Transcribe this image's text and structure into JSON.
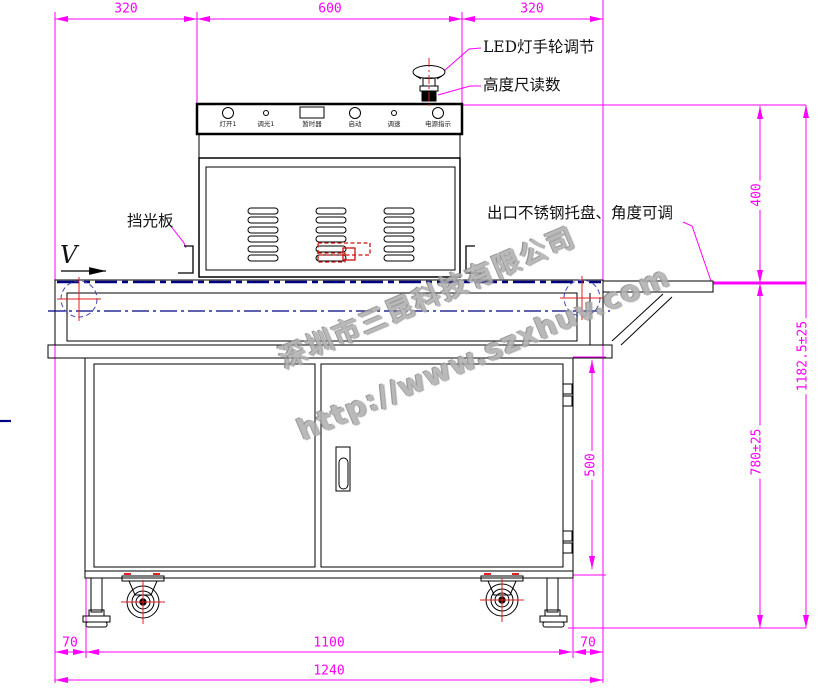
{
  "dims": {
    "top_left": "320",
    "top_mid": "600",
    "top_right": "320",
    "right_400": "400",
    "right_1182": "1182.5±25",
    "right_780": "780±25",
    "right_500": "500",
    "bottom_left70": "70",
    "bottom_1100": "1100",
    "bottom_right70": "70",
    "bottom_1240": "1240"
  },
  "annotations": {
    "led_handwheel": "LED灯手轮调节",
    "height_gauge": "高度尺读数",
    "light_shield": "挡光板",
    "outlet_tray": "出口不锈钢托盘、角度可调",
    "belt_direction": "V"
  },
  "control_panel": {
    "items": [
      {
        "label": "灯开1",
        "type": "circle-large"
      },
      {
        "label": "调光1",
        "type": "circle-small"
      },
      {
        "label": "暂时器",
        "type": "rect-window"
      },
      {
        "label": "启动",
        "type": "circle-large"
      },
      {
        "label": "调速",
        "type": "circle-small"
      },
      {
        "label": "电源指示",
        "type": "circle-large"
      }
    ]
  },
  "watermark": {
    "company": "深圳市三昆科技有限公司",
    "url": "http://www.szxhuv.com"
  },
  "colors": {
    "dimension": "#FF00FF",
    "line": "#000000",
    "belt": "#000080",
    "centerline": "#E02020",
    "roller_circle": "#4444BB",
    "detail_red": "#CC1111",
    "watermark": "#B0B0B0"
  }
}
